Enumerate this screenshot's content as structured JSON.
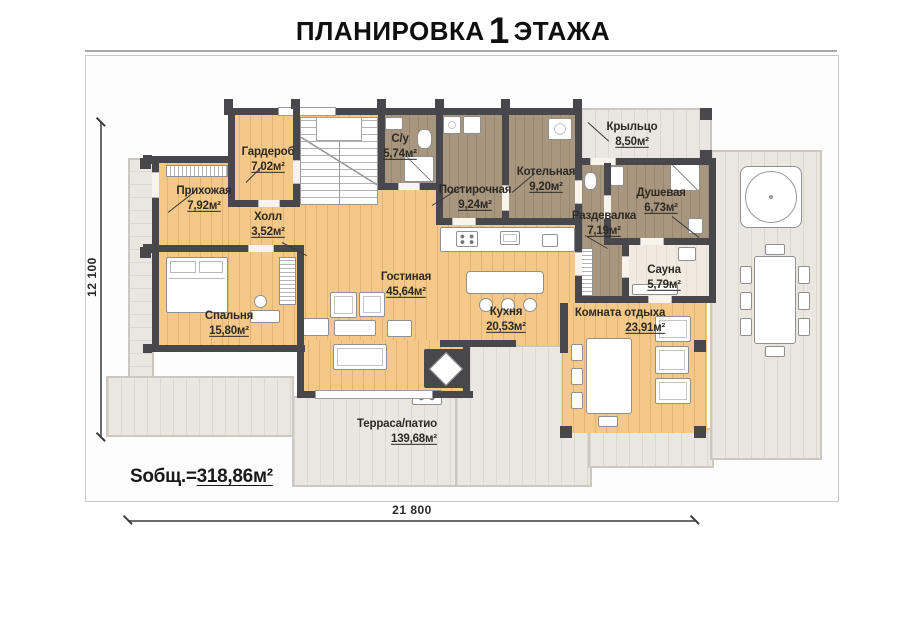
{
  "title": {
    "part1": "ПЛАНИРОВКА",
    "big": "1",
    "part2": "ЭТАЖА"
  },
  "rooms": [
    {
      "id": "hallway",
      "name": "Прихожая",
      "area": "7,92м²"
    },
    {
      "id": "wardrobe",
      "name": "Гардероб",
      "area": "7,02м²"
    },
    {
      "id": "hall",
      "name": "Холл",
      "area": "3,52м²"
    },
    {
      "id": "bathroom",
      "name": "С/у",
      "area": "5,74м²"
    },
    {
      "id": "laundry",
      "name": "Постирочная",
      "area": "9,24м²"
    },
    {
      "id": "boiler",
      "name": "Котельная",
      "area": "9,20м²"
    },
    {
      "id": "porch",
      "name": "Крыльцо",
      "area": "8,50м²"
    },
    {
      "id": "shower",
      "name": "Душевая",
      "area": "6,73м²"
    },
    {
      "id": "changing",
      "name": "Раздевалка",
      "area": "7,19м²"
    },
    {
      "id": "sauna",
      "name": "Сауна",
      "area": "5,79м²"
    },
    {
      "id": "lounge",
      "name": "Комната отдыха",
      "area": "23,91м²"
    },
    {
      "id": "kitchen",
      "name": "Кухня",
      "area": "20,53м²"
    },
    {
      "id": "living",
      "name": "Гостиная",
      "area": "45,64м²"
    },
    {
      "id": "bedroom",
      "name": "Спальня",
      "area": "15,80м²"
    },
    {
      "id": "terrace",
      "name": "Терраса/патио",
      "area": "139,68м²"
    }
  ],
  "dimensions": {
    "width": "21 800",
    "height": "12 100"
  },
  "total_area": {
    "label": "Sобщ.=",
    "value": "318,86м²"
  },
  "colors": {
    "wall": "#47474c",
    "wood_floor": "#f3c888",
    "wet_floor": "#a8967e",
    "terrace_floor": "#eae6e0",
    "sauna_floor": "#f0eae1",
    "text": "#2d2a24"
  }
}
